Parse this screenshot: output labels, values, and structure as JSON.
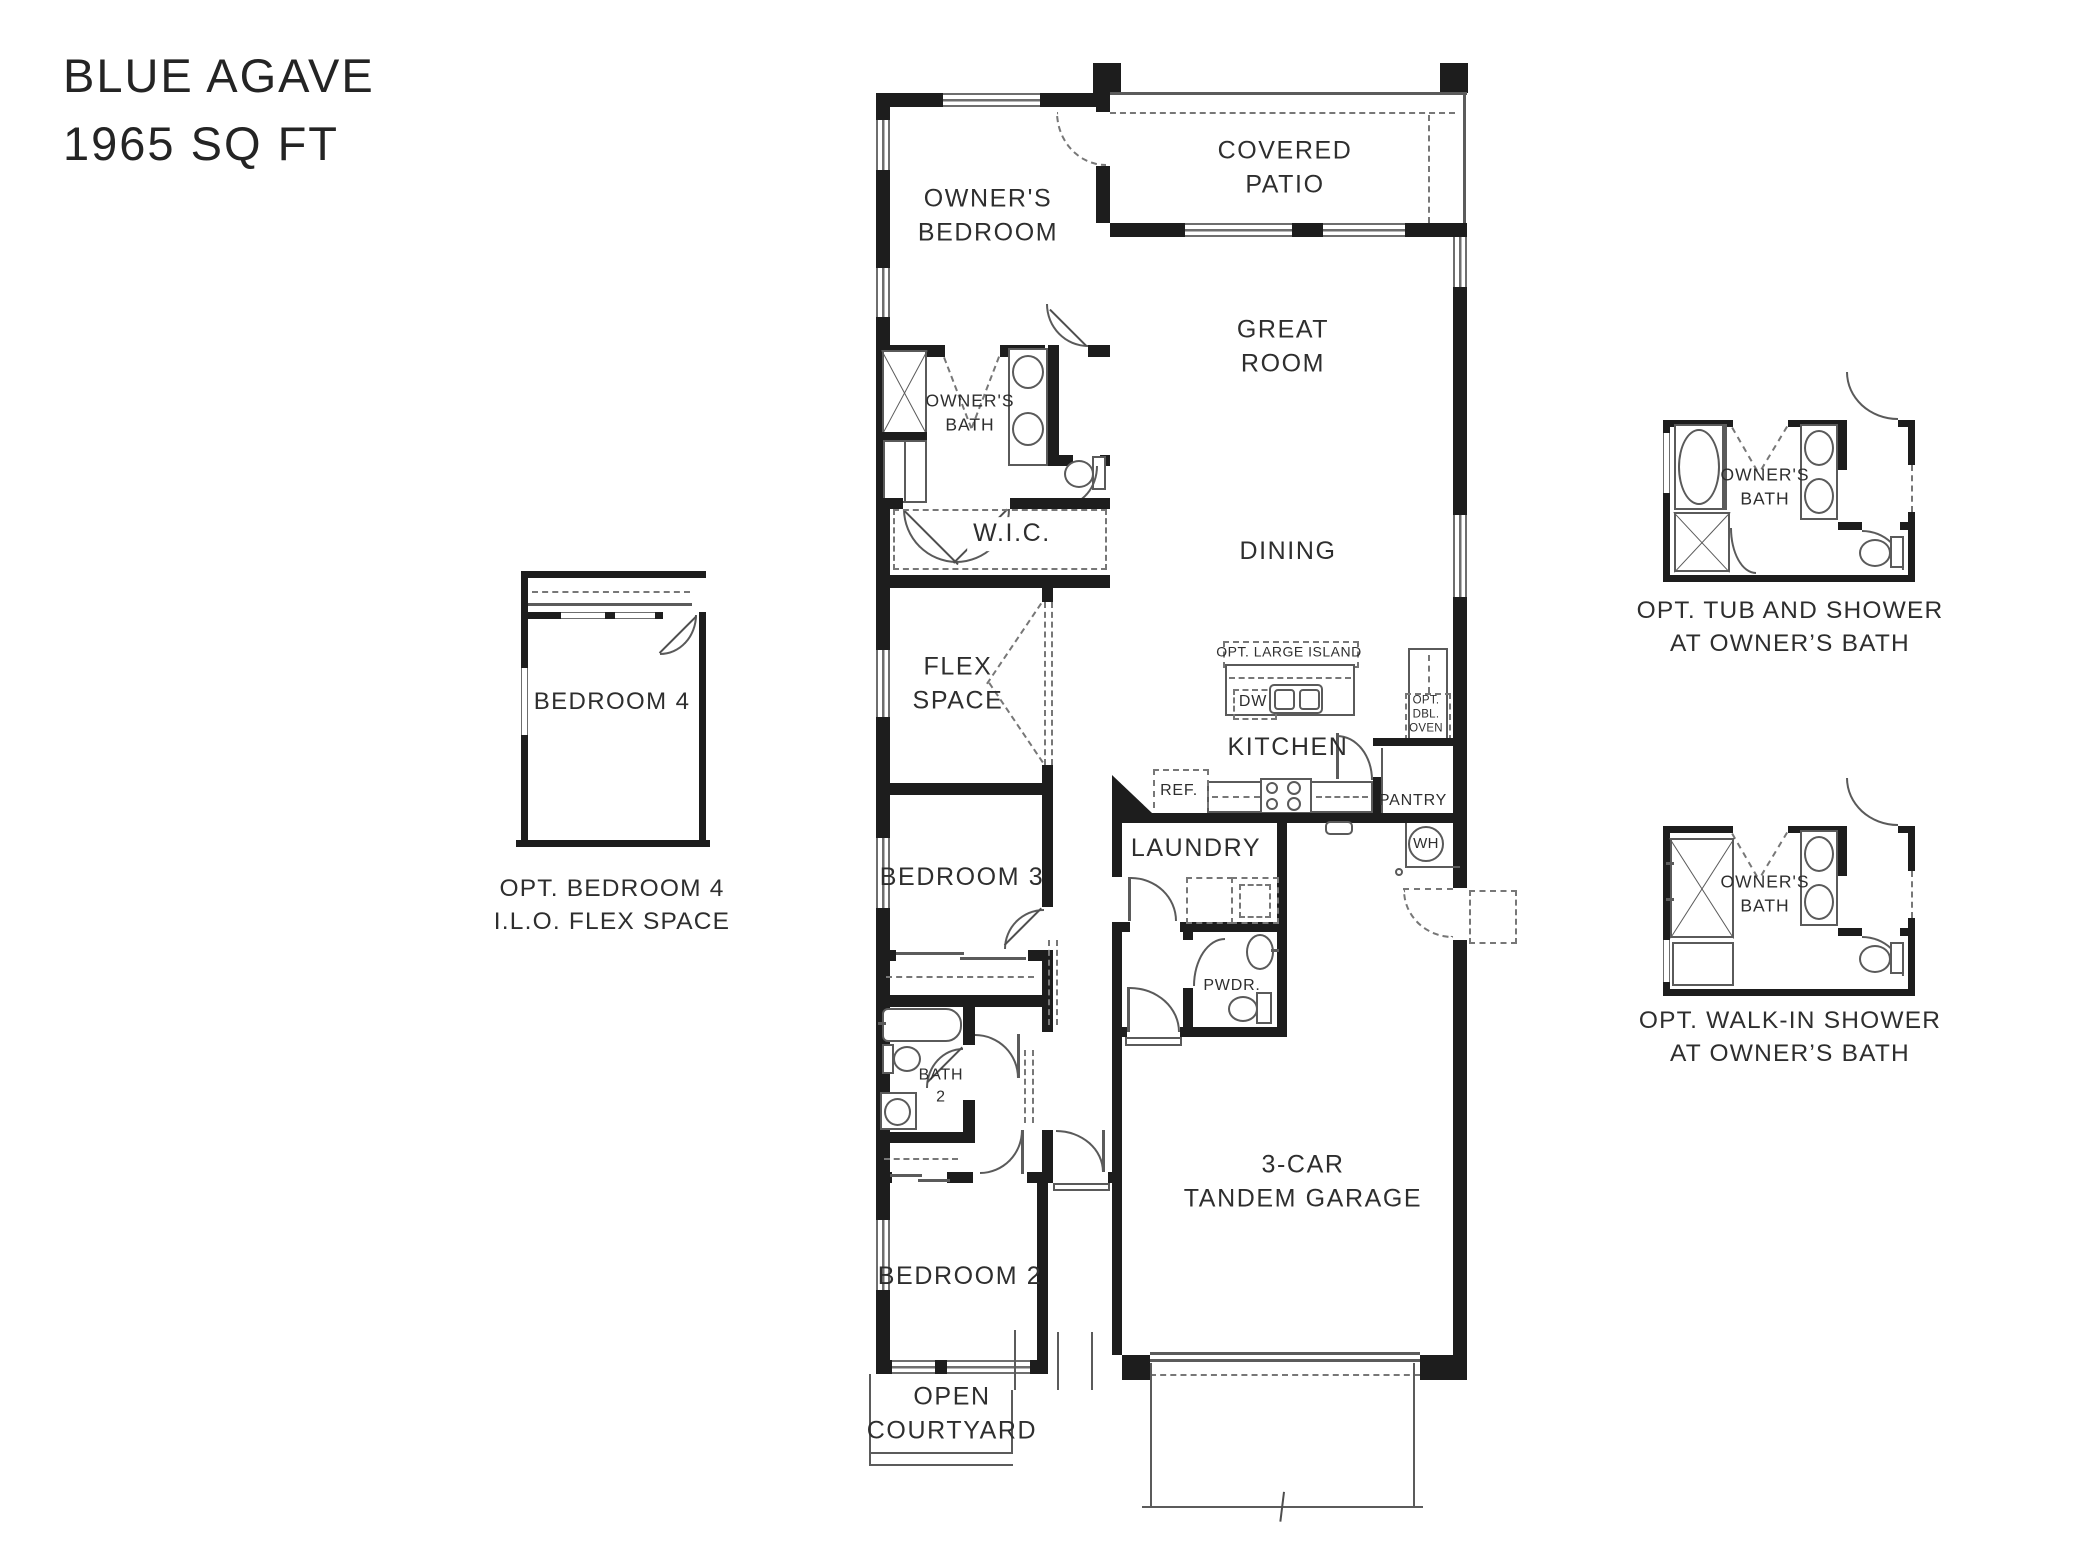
{
  "title": {
    "name": "BLUE AGAVE",
    "sqft": "1965 SQ FT"
  },
  "colors": {
    "wall": "#1d1d1d",
    "line": "#5b5b5b",
    "dash": "#777777",
    "text": "#2e2e2e",
    "background": "#ffffff"
  },
  "plan": {
    "rooms": {
      "owners_bedroom": "OWNER'S\nBEDROOM",
      "covered_patio": "COVERED\nPATIO",
      "great_room": "GREAT\nROOM",
      "owners_bath": "OWNER'S\nBATH",
      "wic": "W.I.C.",
      "dining": "DINING",
      "flex_space": "FLEX\nSPACE",
      "kitchen": "KITCHEN",
      "laundry": "LAUNDRY",
      "pwdr": "PWDR.",
      "pantry": "PANTRY",
      "bath_2": "BATH\n2",
      "bedroom_3": "BEDROOM 3",
      "bedroom_2": "BEDROOM 2",
      "garage": "3-CAR\nTANDEM GARAGE",
      "open_courtyard": "OPEN\nCOURTYARD"
    },
    "fixtures": {
      "dw": "DW",
      "ref": "REF.",
      "wh": "WH",
      "opt_large_island": "OPT. LARGE ISLAND",
      "opt_dbl_oven": "OPT.\nDBL.\nOVEN"
    }
  },
  "insets": {
    "bedroom4": {
      "room": "BEDROOM 4",
      "caption": "OPT. BEDROOM 4\nI.L.O. FLEX SPACE"
    },
    "opt_tub_shower": {
      "room": "OWNER'S\nBATH",
      "caption": "OPT. TUB AND SHOWER\nAT OWNER’S BATH"
    },
    "opt_walkin_shower": {
      "room": "OWNER'S\nBATH",
      "caption": "OPT. WALK-IN SHOWER\nAT OWNER’S BATH"
    }
  }
}
